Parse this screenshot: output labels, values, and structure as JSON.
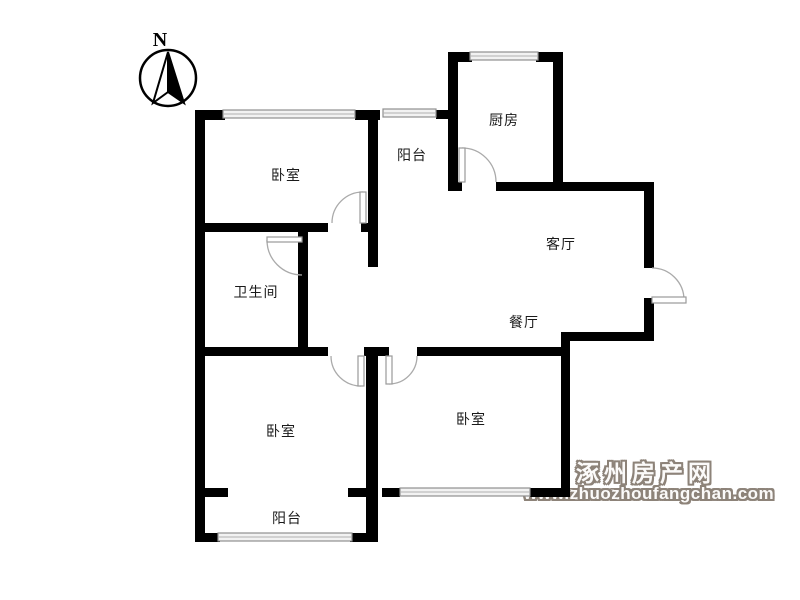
{
  "compass": {
    "north_label": "N"
  },
  "rooms": [
    {
      "id": "bedroom-top-left",
      "label": "卧室"
    },
    {
      "id": "balcony-top",
      "label": "阳台"
    },
    {
      "id": "kitchen",
      "label": "厨房"
    },
    {
      "id": "living-room",
      "label": "客厅"
    },
    {
      "id": "bathroom",
      "label": "卫生间"
    },
    {
      "id": "dining-room",
      "label": "餐厅"
    },
    {
      "id": "bedroom-bottom-left",
      "label": "卧室"
    },
    {
      "id": "bedroom-bottom-right",
      "label": "卧室"
    },
    {
      "id": "balcony-bottom",
      "label": "阳台"
    }
  ],
  "watermark": {
    "site_name": "涿州房产网",
    "site_url": "www.zhuozhoufangchan.com",
    "color": "#8d8379"
  },
  "colors": {
    "background": "#ffffff",
    "wall": "#000000",
    "door_arc": "#aaaaaa",
    "window_line": "#8f8f8f",
    "label_text": "#1a1a1a"
  }
}
